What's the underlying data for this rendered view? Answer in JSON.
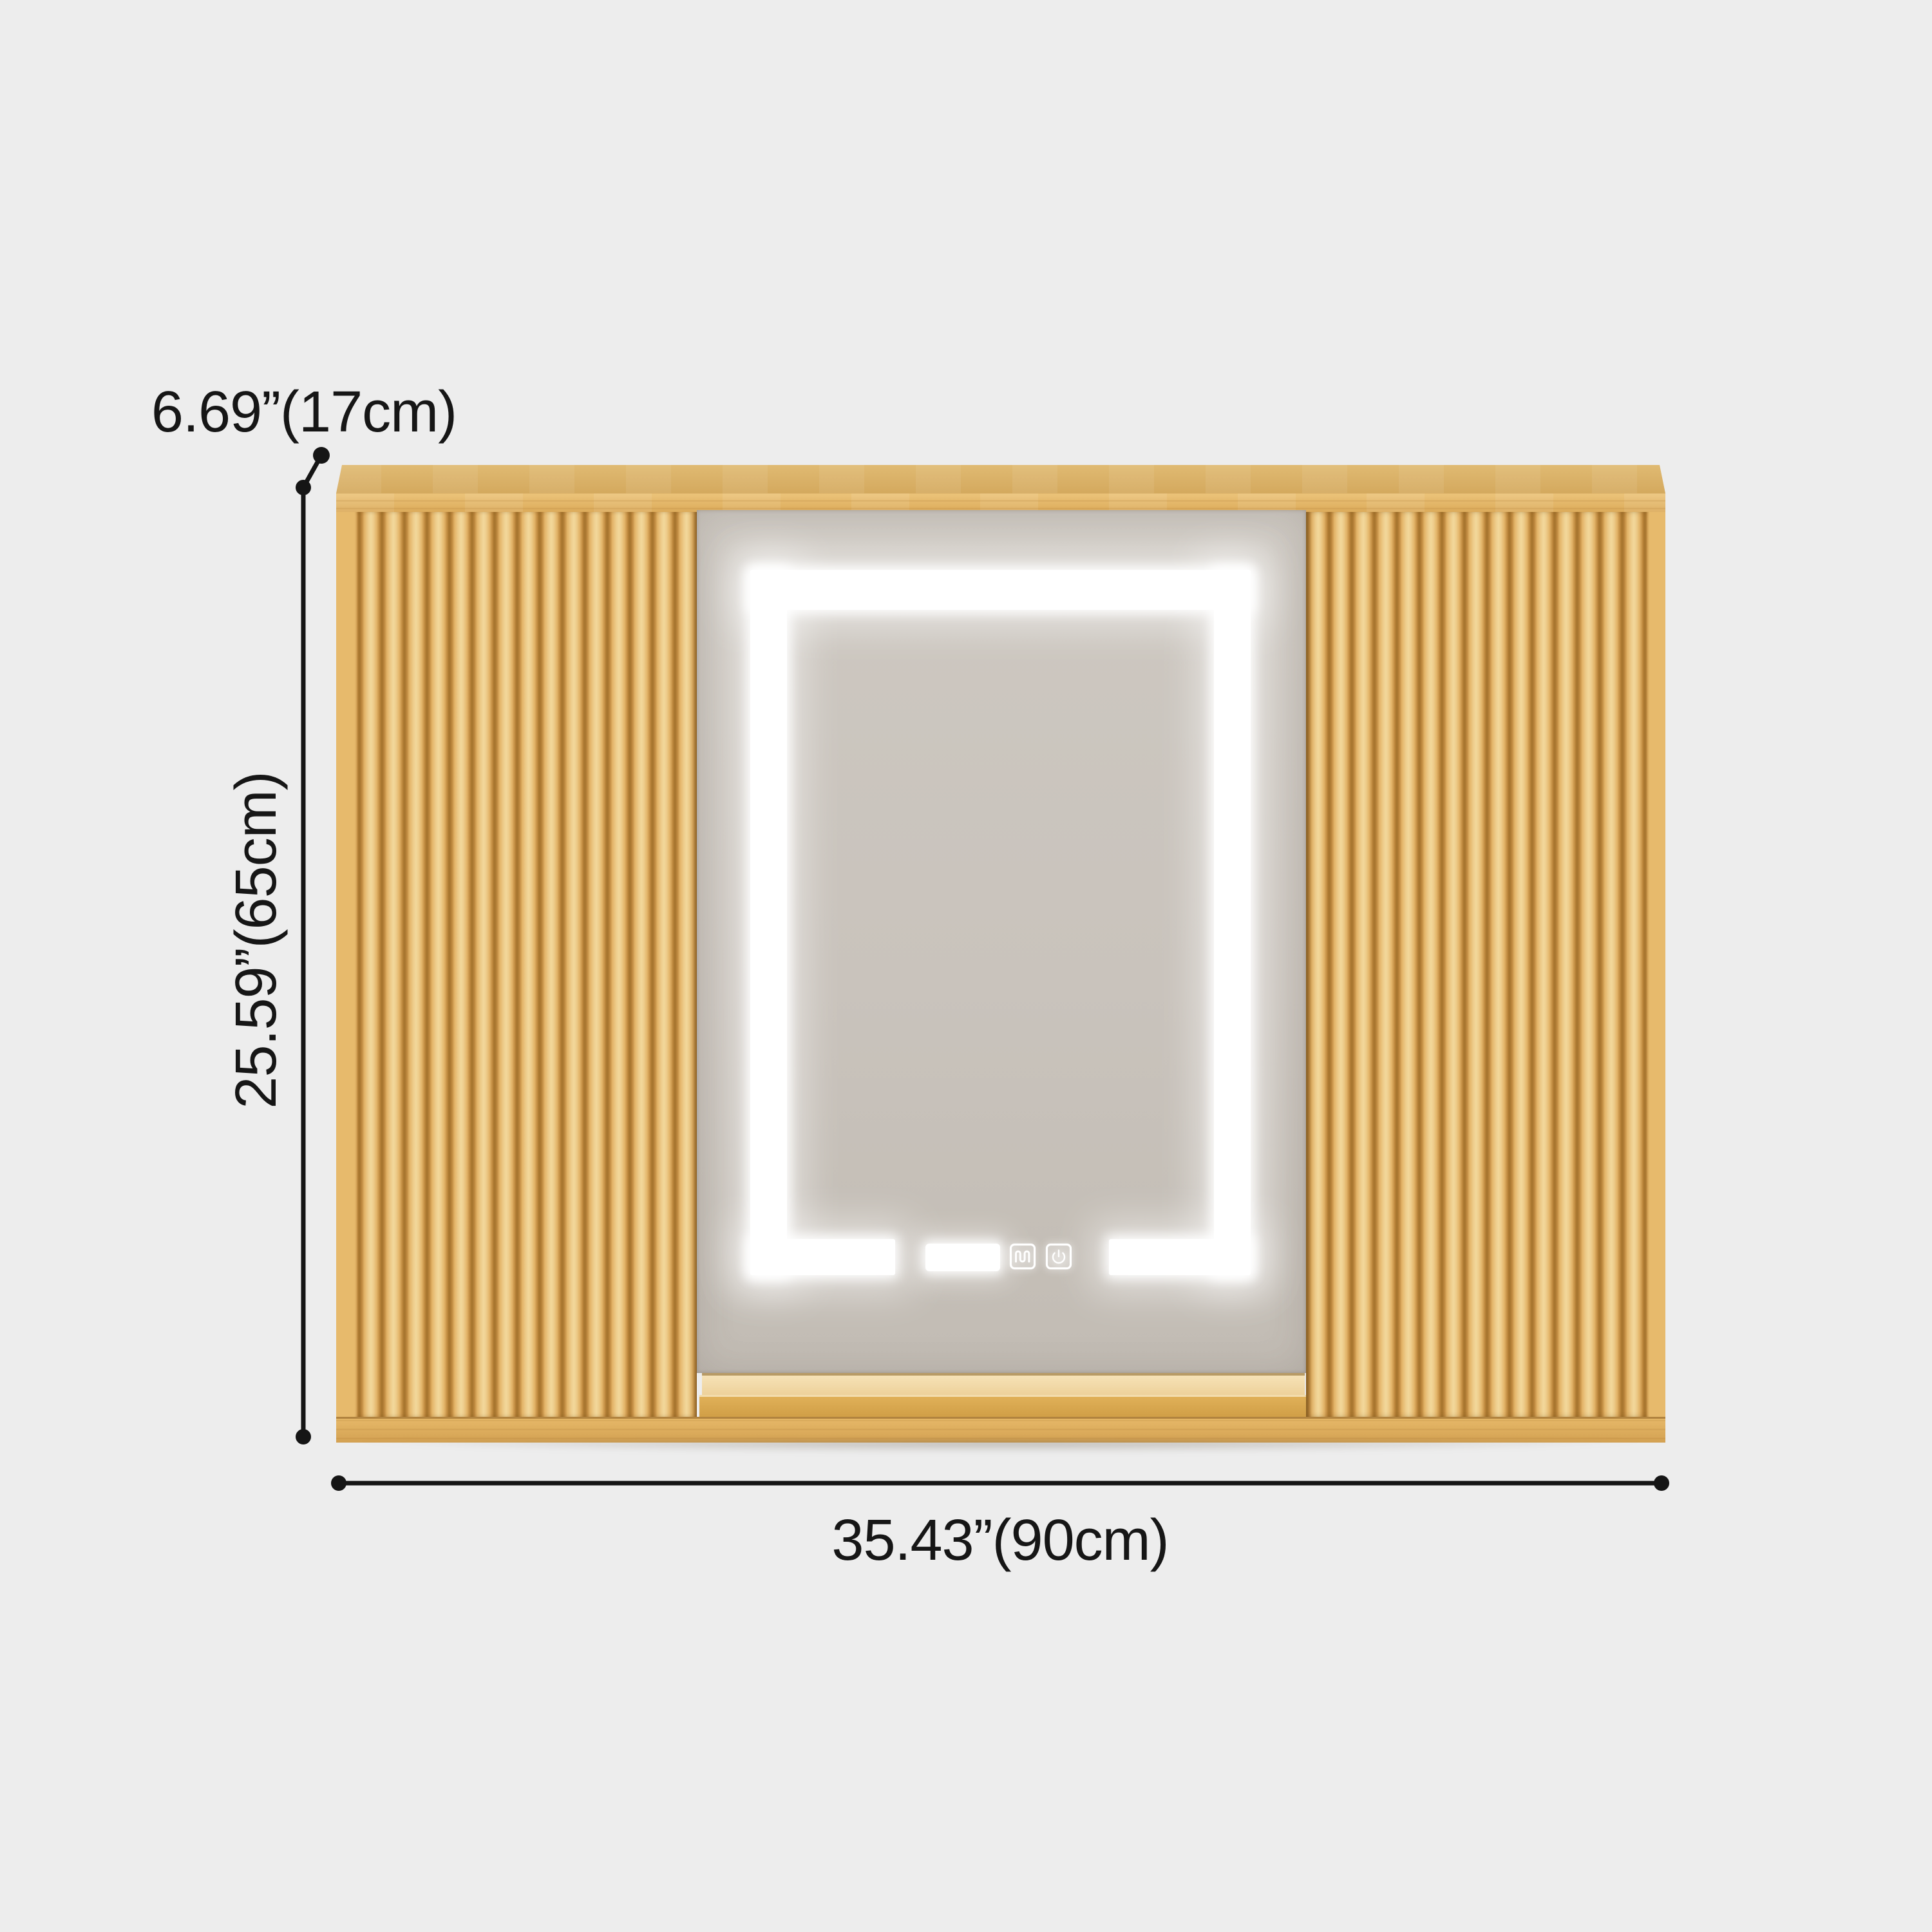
{
  "annotations": {
    "depth_label": "6.69”(17cm)",
    "height_label": "25.59”(65cm)",
    "width_label": "35.43”(90cm)"
  },
  "icons": {
    "defog_icon": "defogger-heating-coil",
    "power_icon": "power-symbol",
    "display_window": "led-light-window"
  },
  "colors": {
    "background": "#ededed",
    "wood_light": "#eecd8c",
    "wood_mid": "#e3b468",
    "wood_groove": "#a8762f",
    "wood_top": "#d9b067",
    "shelf_back": "#f5e1b3",
    "shelf_floor": "#d7a64c",
    "mirror_glass": "#c9c3bc",
    "led_white": "#ffffff",
    "dim_line": "#151515"
  }
}
